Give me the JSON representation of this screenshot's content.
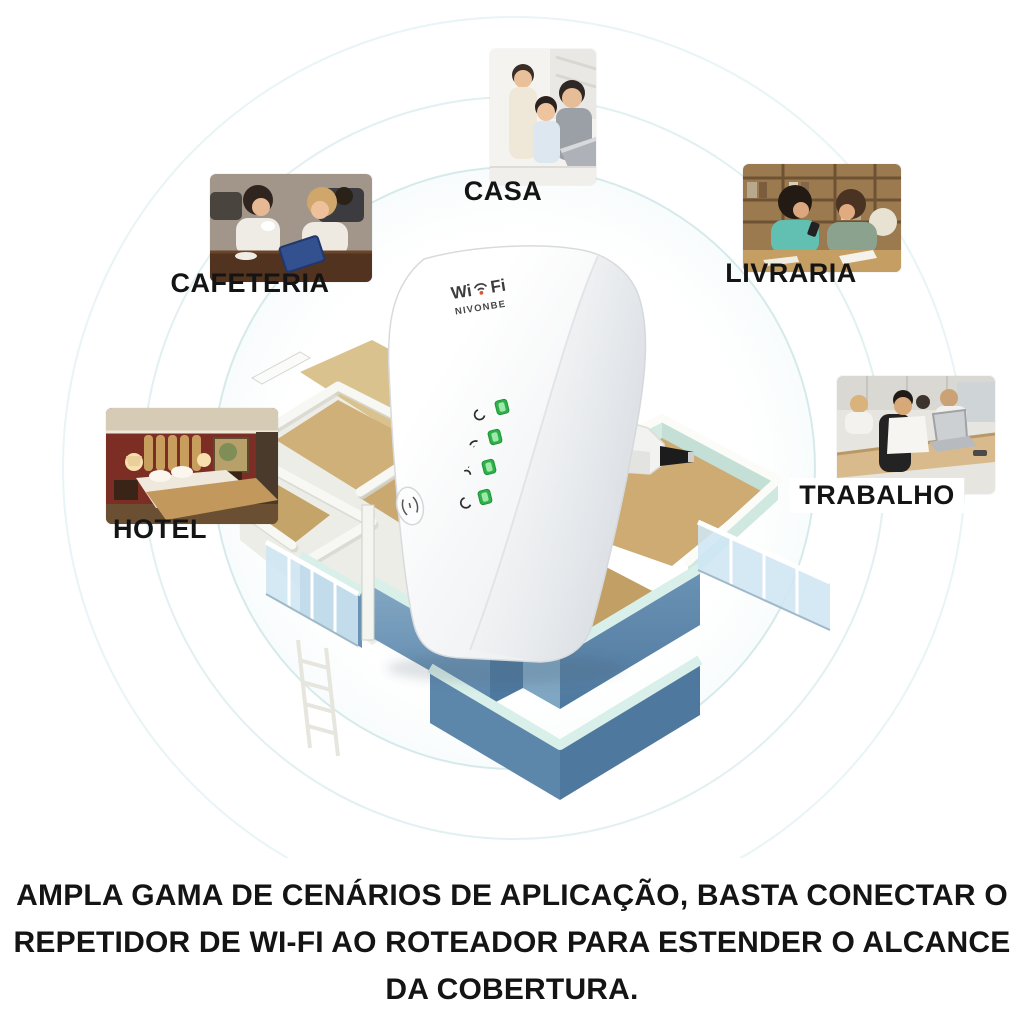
{
  "scenarios": [
    {
      "id": "casa",
      "label": "CASA"
    },
    {
      "id": "cafeteria",
      "label": "CAFETERIA"
    },
    {
      "id": "livraria",
      "label": "LIVRARIA"
    },
    {
      "id": "hotel",
      "label": "HOTEL"
    },
    {
      "id": "trabalho",
      "label": "TRABALHO"
    }
  ],
  "device": {
    "logo": {
      "prefix": "Wi",
      "suffix": "Fi",
      "icon": "wifi-signal-icon"
    },
    "brand": "NIVONBE",
    "leds": [
      {
        "icon": "power-icon",
        "state": "on"
      },
      {
        "icon": "wifi-icon",
        "state": "on"
      },
      {
        "icon": "wps-icon",
        "state": "on"
      },
      {
        "icon": "lan-icon",
        "state": "on"
      }
    ],
    "button_icon": "wps-button-icon",
    "led_color": "#2fb14a"
  },
  "caption": {
    "line1": "AMPLA GAMA DE CENÁRIOS DE APLICAÇÃO, BASTA CONECTAR O",
    "line2": "REPETIDOR DE WI-FI AO ROTEADOR PARA ESTENDER O ALCANCE",
    "line3": "DA COBERTURA."
  },
  "colors": {
    "ring": "#cfe4e6",
    "floor_tan": "#c9a96f",
    "exterior_wall_blue": "#5d86ab",
    "wall_top_mint": "#d9efe9",
    "text": "#141414"
  }
}
